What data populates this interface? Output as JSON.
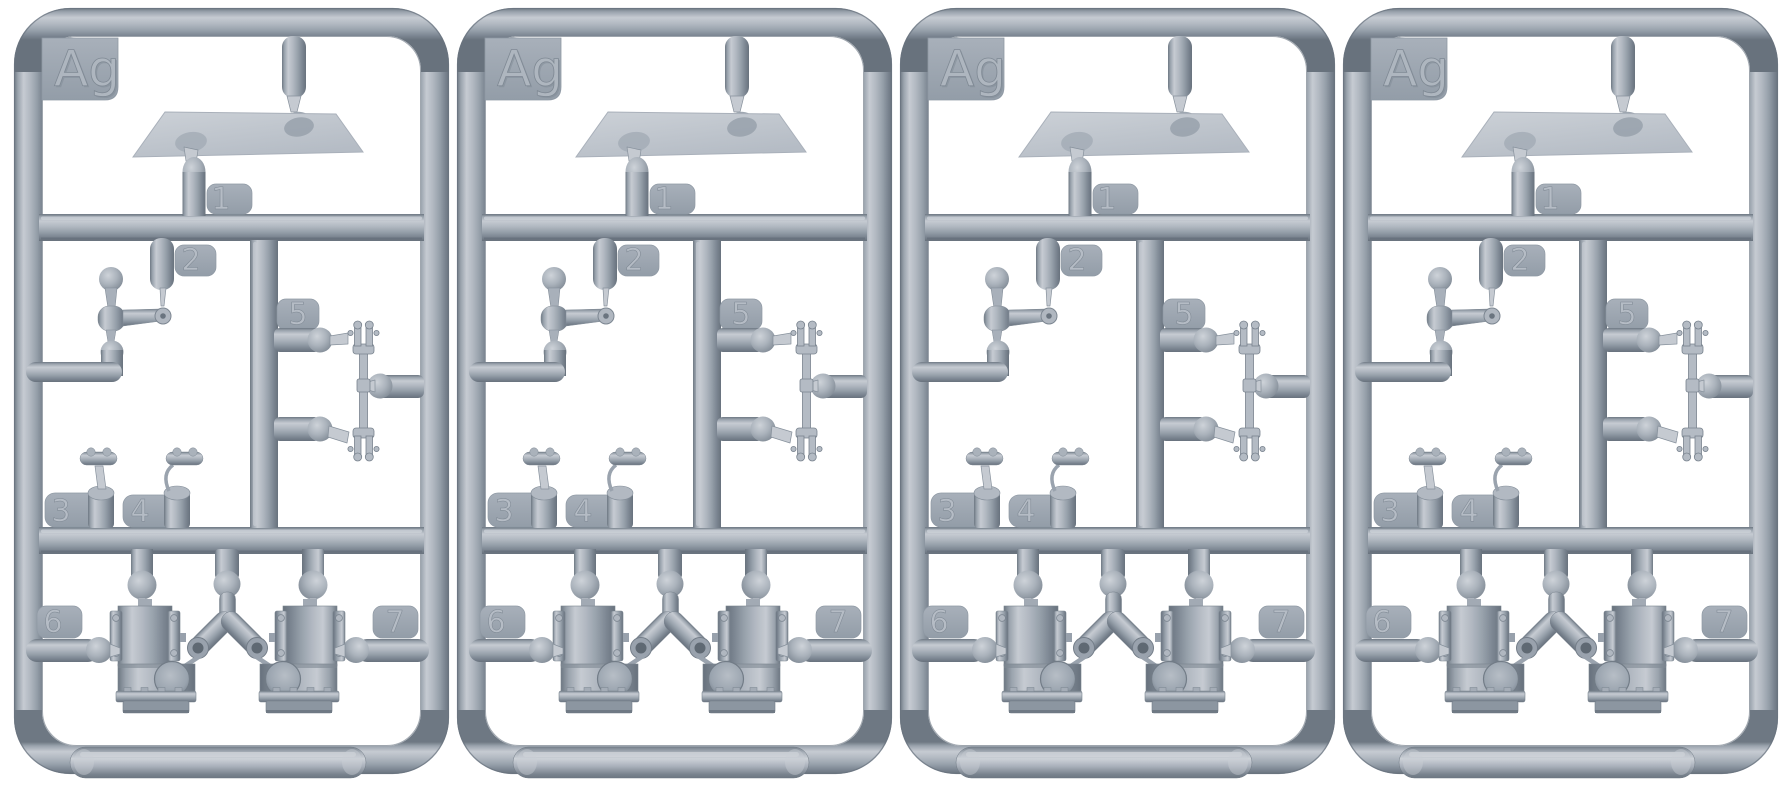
{
  "scene": {
    "type": "product-photo",
    "subject": "Four identical grey plastic injection-molded model kit sprues (runner frames), each holding small parts",
    "background_color": "#ffffff",
    "plastic_color_mid": "#99a3ae",
    "plastic_color_light": "#c7ccd3",
    "plastic_color_dark": "#6e7883"
  },
  "sprues": {
    "count": 4,
    "code_label": "Ag",
    "part_tab_numbers": [
      "1",
      "2",
      "3",
      "4",
      "5",
      "6",
      "7"
    ]
  },
  "labels": {
    "ag": "Ag",
    "p1": "1",
    "p2": "2",
    "p3": "3",
    "p4": "4",
    "p5": "5",
    "p6": "6",
    "p7": "7"
  }
}
